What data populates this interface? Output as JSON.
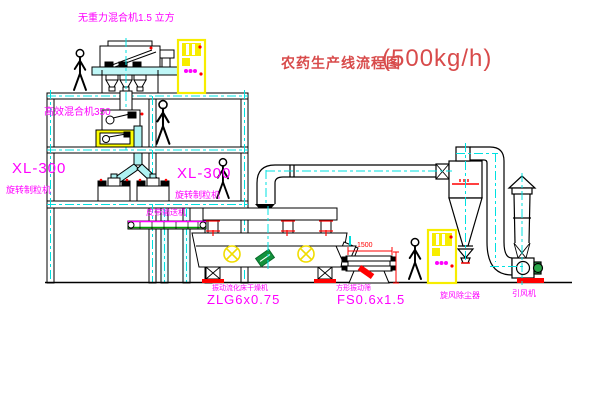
{
  "title": {
    "text": "农药生产线流程图",
    "capacity": "(500kg/h)"
  },
  "labels": {
    "gravity_mixer": "无重力混合机1.5 立方",
    "high_efficiency_mixer": "高效混合机350",
    "granulator_left_model": "XL-300",
    "granulator_left_name": "旋转制粒机",
    "granulator_right_model": "XL-300",
    "granulator_right_name": "旋转制粒机",
    "belt_conveyor": "皮带输送机",
    "dryer_name": "振动流化床干燥机",
    "dryer_model": "ZLG6x0.75",
    "screen_name": "方形振动筛",
    "screen_model": "FS0.6x1.5",
    "cyclone": "旋风除尘器",
    "fan": "引风机"
  },
  "dimensions": {
    "screen_length": "1500"
  },
  "colors": {
    "outline": "#000000",
    "centerline": "#00e0e0",
    "label": "#ff00ff",
    "title": "#d84b4b",
    "dimension": "#ff0000",
    "highlight": "#f7ed00",
    "pipe_fill": "#aef2f2",
    "motor": "#2aa84a",
    "conveyor_belt": "#00a000"
  }
}
